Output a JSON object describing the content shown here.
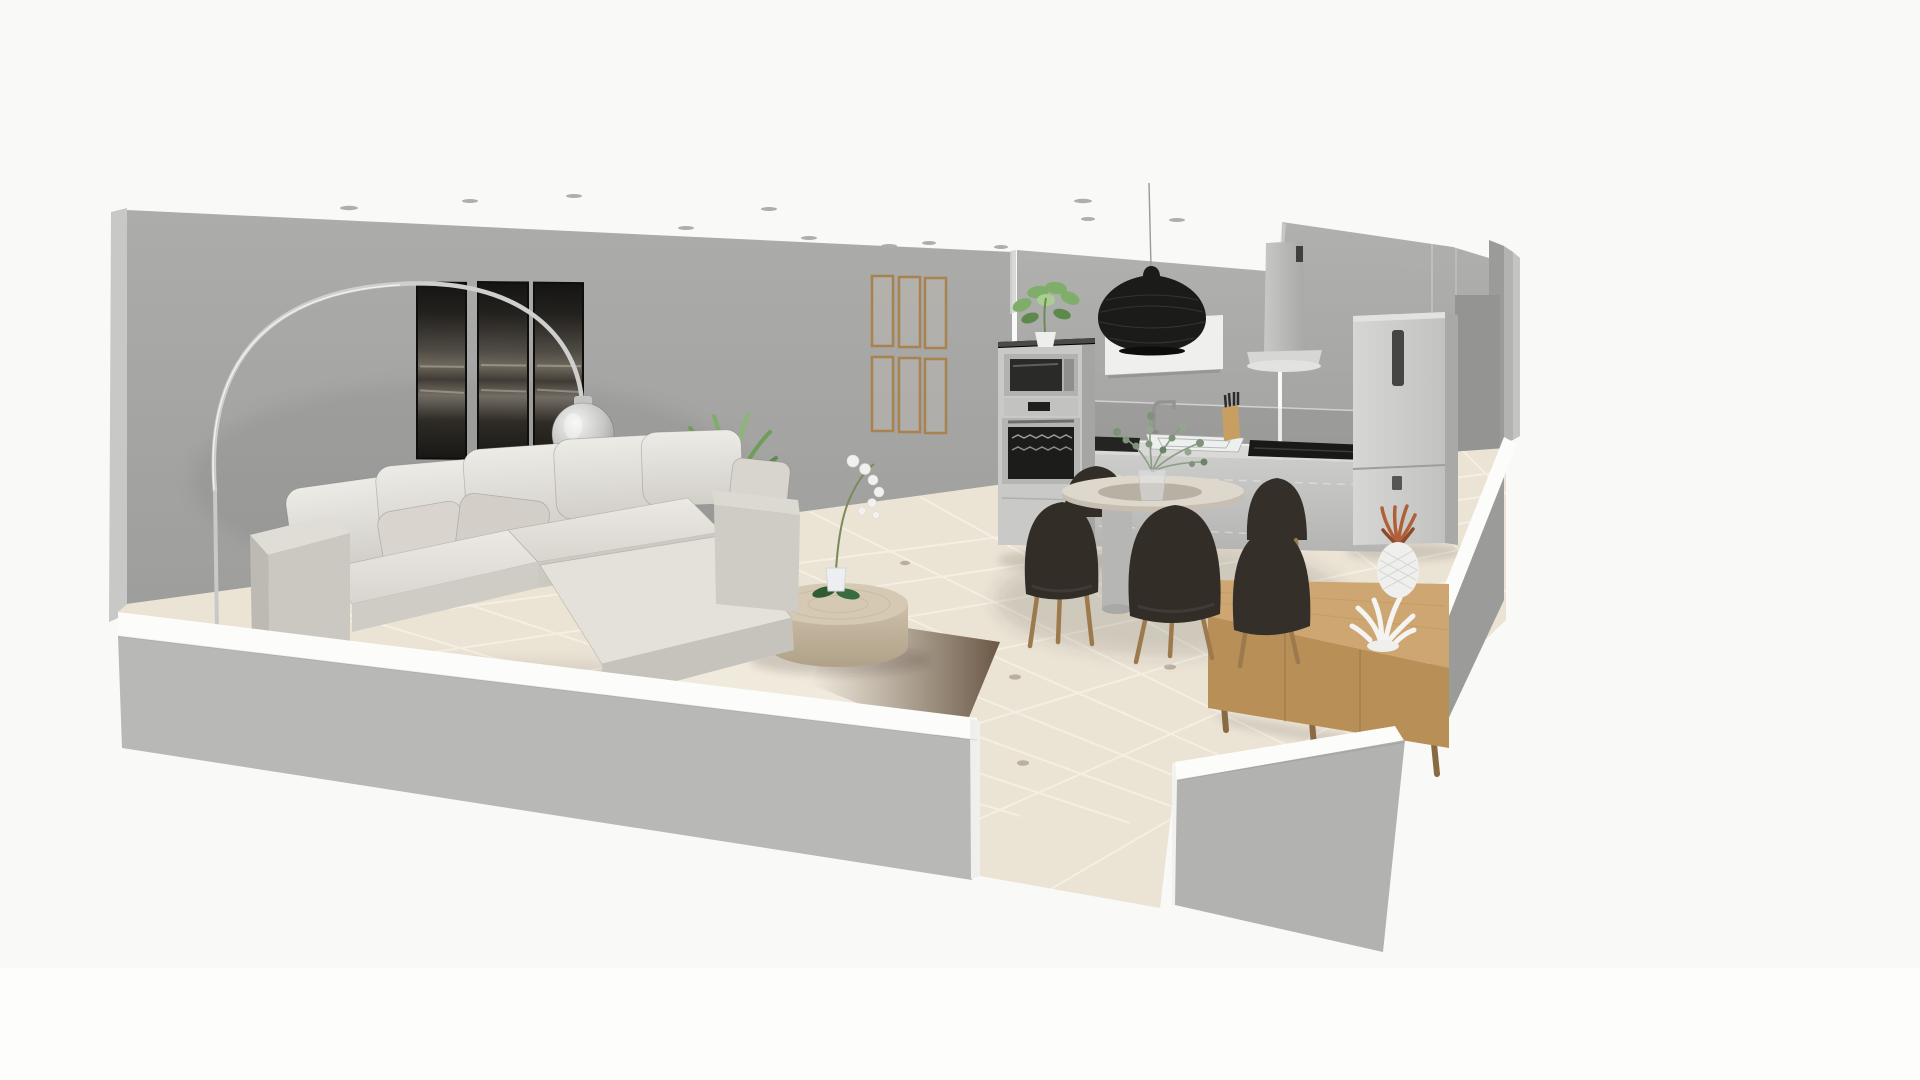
{
  "app": {
    "type": "3d-home-design-viewport",
    "view_mode": "3D room cutaway view",
    "background_color": "#f9f9f8"
  },
  "palette": {
    "wall_gray": "#a6a6a4",
    "wall_kitchen": "#aaaaa8",
    "half_wall_top_white": "#fcfcfa",
    "half_wall_outer": "#b8b8b6",
    "floor_tile": "#ebe3d4",
    "grout": "#f6f0e5",
    "sofa_fabric": "#e6e3de",
    "chair_fabric": "#332d28",
    "wood_oak": "#c89f6e",
    "wood_leg": "#9c7a4e",
    "pendant_black": "#1b1b19",
    "appliance_steel": "#c9c9c7",
    "plant_green": "#6e9e58"
  },
  "scene": {
    "room": {
      "label": "Open plan living room and kitchen, cutaway 3D view",
      "walls_color": "#a6a6a4",
      "floor_tile_color": "#ebe3d4"
    },
    "objects": {
      "triptych_art": {
        "label": "Abstract black triptych wall art",
        "panels": 3
      },
      "wooden_frames": {
        "label": "Grid of empty wooden frames",
        "count": 6
      },
      "arc_lamp": {
        "label": "Chrome arc floor lamp with glass globe shade"
      },
      "sofa": {
        "label": "Light gray sectional sofa with chaise",
        "pillow_count": 8
      },
      "yucca": {
        "label": "Yucca plant behind sofa"
      },
      "rug": {
        "label": "Two-tone cream and brown area rug"
      },
      "coffee_table": {
        "label": "Round wooden drum coffee table"
      },
      "orchid": {
        "label": "White orchid in white pot"
      },
      "oven_column": {
        "label": "Tall oven column with microwave and oven"
      },
      "oven_plant": {
        "label": "Potted green plant on oven column"
      },
      "pendant_lamp": {
        "label": "Black woven rattan pendant lamp"
      },
      "wall_panel": {
        "label": "White rectangular wall panel"
      },
      "hood": {
        "label": "Wall chimney range hood"
      },
      "fridge": {
        "label": "Freestanding fridge freezer"
      },
      "counter": {
        "label": "Kitchen counter with sink and dark cooktop"
      },
      "sink": {
        "label": "White kitchen sink"
      },
      "faucet": {
        "label": "Kitchen faucet"
      },
      "knife_block": {
        "label": "Wooden knife block with knives"
      },
      "dining_table": {
        "label": "Round pedestal dining table"
      },
      "eucalyptus": {
        "label": "Eucalyptus stems in glass vase"
      },
      "dining_chairs": {
        "label": "Dark brown upholstered dining chairs with wood legs",
        "count": 5
      },
      "sideboard": {
        "label": "Light oak sideboard"
      },
      "coral": {
        "label": "White coral ornament"
      },
      "pineapple": {
        "label": "White ceramic pineapple with copper leaves"
      },
      "spotlights": {
        "label": "Recessed ceiling spotlights",
        "count": 13
      }
    }
  }
}
